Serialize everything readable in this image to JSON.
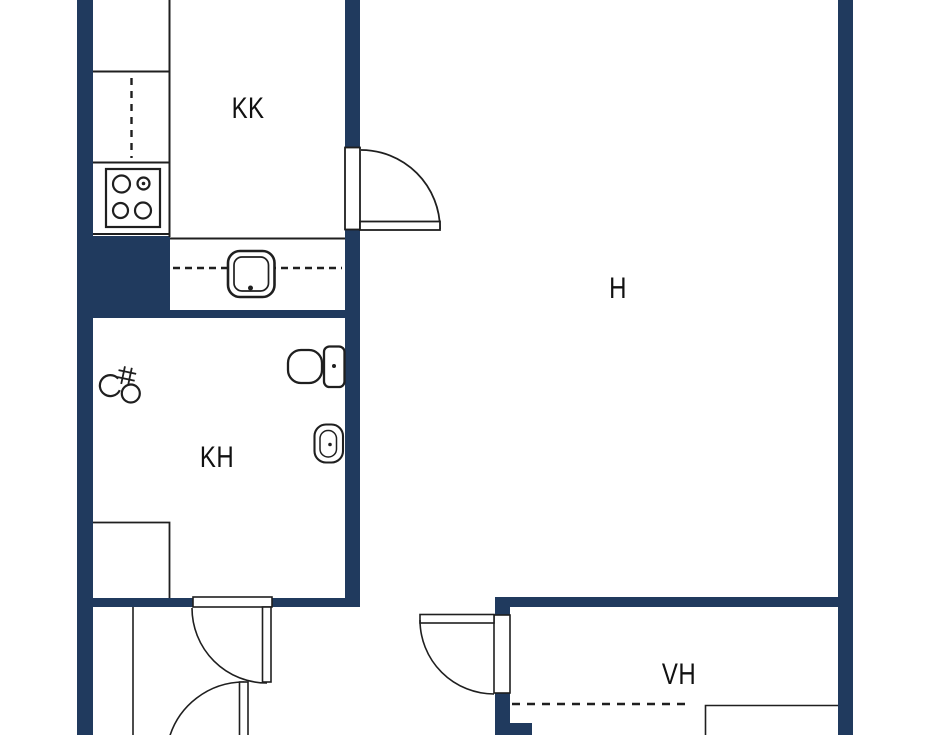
{
  "floorplan": {
    "rooms": [
      {
        "id": "kk",
        "label": "KK"
      },
      {
        "id": "h",
        "label": "H"
      },
      {
        "id": "kh",
        "label": "KH"
      },
      {
        "id": "vh",
        "label": "VH"
      }
    ]
  },
  "colors": {
    "wall": "#203a5e",
    "line": "#1f1f1f",
    "text": "#111111",
    "bg": "#ffffff"
  }
}
